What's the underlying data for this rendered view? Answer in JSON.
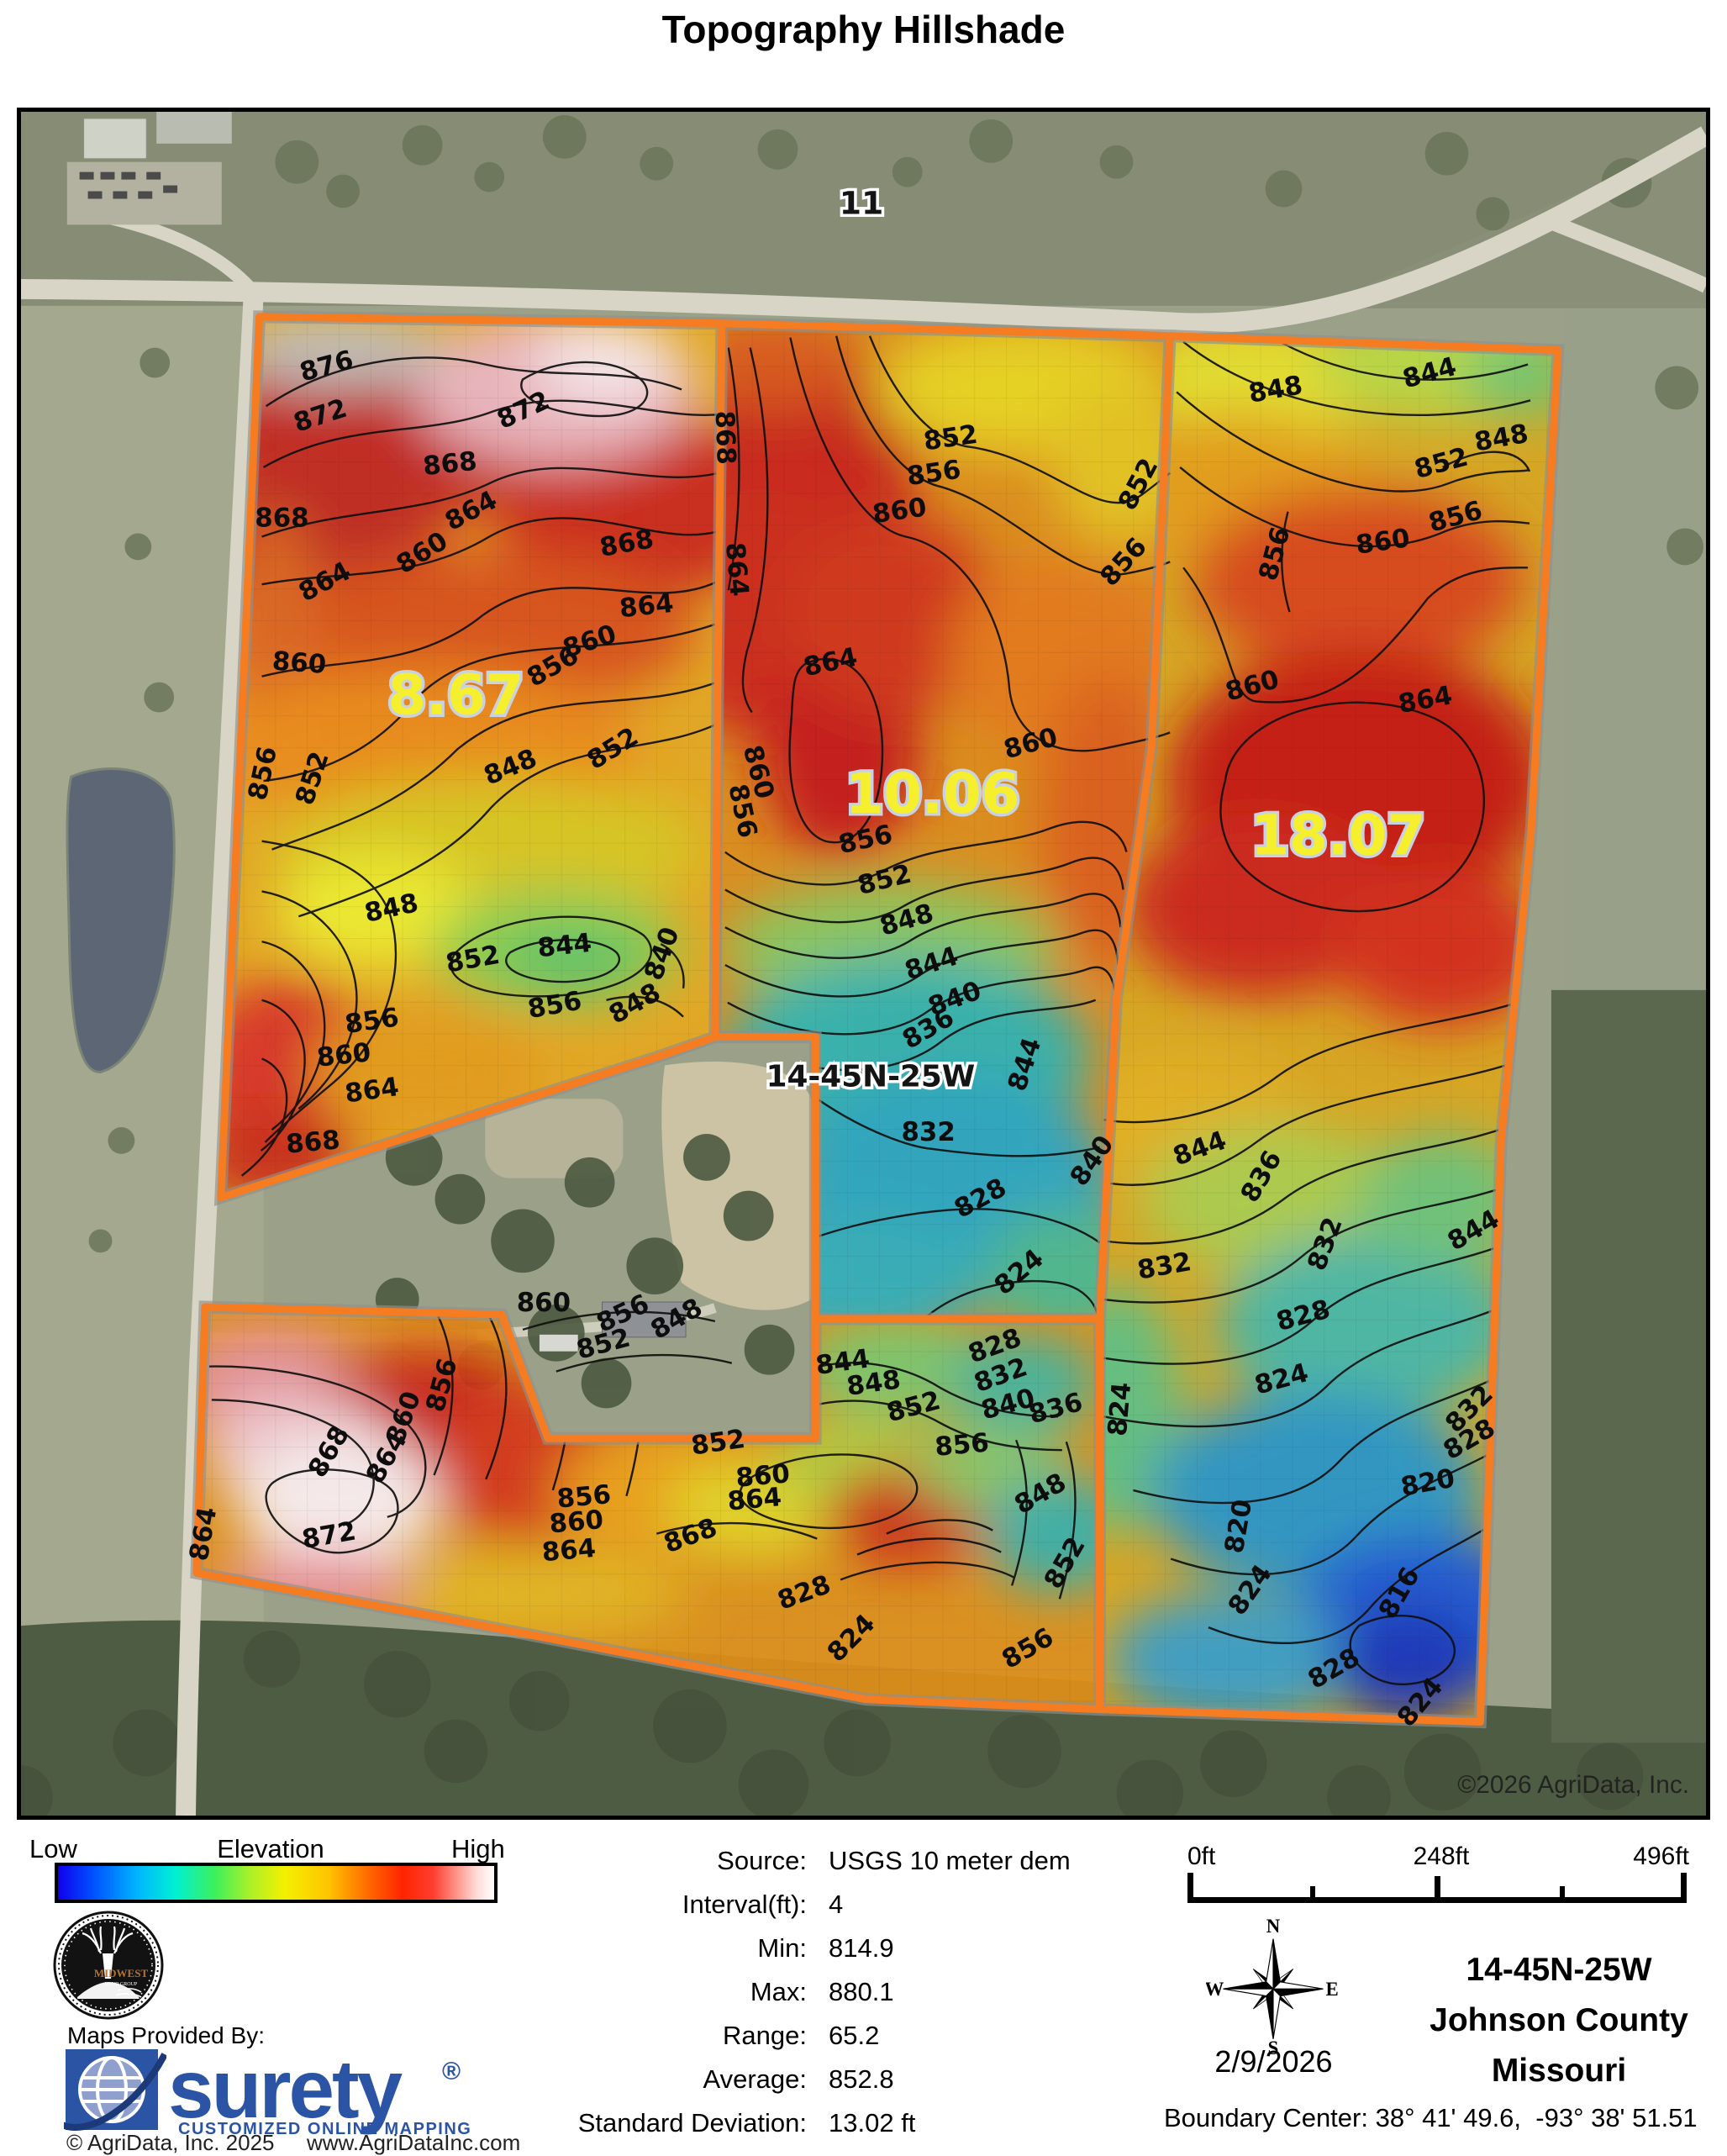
{
  "title": "Topography Hillshade",
  "map": {
    "section_label_top": "11",
    "section_label_center": "14-45N-25W",
    "copyright": "©2026 AgriData, Inc.",
    "parcel_labels": [
      [
        "8.67",
        520,
        720
      ],
      [
        "10.06",
        1090,
        838
      ],
      [
        "18.07",
        1575,
        888
      ]
    ],
    "contour_labels": [
      [
        "876",
        368,
        314,
        -15
      ],
      [
        "872",
        361,
        373,
        -18
      ],
      [
        "872",
        605,
        366,
        -25
      ],
      [
        "868",
        514,
        431,
        -6
      ],
      [
        "868",
        312,
        496,
        0
      ],
      [
        "864",
        543,
        486,
        -28
      ],
      [
        "868",
        726,
        526,
        -10
      ],
      [
        "860",
        485,
        536,
        -32
      ],
      [
        "864",
        368,
        571,
        -28
      ],
      [
        "864",
        749,
        601,
        -6
      ],
      [
        "860",
        332,
        669,
        4
      ],
      [
        "860",
        683,
        643,
        -18
      ],
      [
        "856",
        641,
        672,
        -30
      ],
      [
        "852",
        713,
        770,
        -32
      ],
      [
        "848",
        589,
        793,
        -22
      ],
      [
        "856",
        299,
        793,
        -78
      ],
      [
        "852",
        358,
        800,
        -72
      ],
      [
        "848",
        445,
        962,
        -12
      ],
      [
        "844",
        651,
        1007,
        -6
      ],
      [
        "840",
        776,
        1010,
        -70
      ],
      [
        "848",
        739,
        1075,
        -30
      ],
      [
        "852",
        542,
        1023,
        -10
      ],
      [
        "856",
        421,
        1097,
        -8
      ],
      [
        "860",
        387,
        1138,
        -6
      ],
      [
        "864",
        421,
        1180,
        -8
      ],
      [
        "868",
        350,
        1242,
        -5
      ],
      [
        "856",
        640,
        1078,
        -10
      ],
      [
        "868",
        832,
        390,
        88
      ],
      [
        "864",
        846,
        548,
        85
      ],
      [
        "852",
        1113,
        400,
        -8
      ],
      [
        "856",
        1093,
        442,
        -8
      ],
      [
        "860",
        1052,
        487,
        -8
      ],
      [
        "852",
        1345,
        450,
        -62
      ],
      [
        "856",
        1326,
        545,
        -48
      ],
      [
        "864",
        970,
        668,
        -12
      ],
      [
        "860",
        1210,
        765,
        -15
      ],
      [
        "860",
        872,
        792,
        75
      ],
      [
        "856",
        853,
        838,
        78
      ],
      [
        "856",
        1012,
        880,
        -12
      ],
      [
        "852",
        1035,
        928,
        -14
      ],
      [
        "848",
        1062,
        976,
        -16
      ],
      [
        "844",
        1092,
        1028,
        -18
      ],
      [
        "840",
        1120,
        1070,
        -20
      ],
      [
        "836",
        1090,
        1105,
        -30
      ],
      [
        "832",
        1085,
        1230,
        0
      ],
      [
        "844",
        1210,
        1142,
        -72
      ],
      [
        "828",
        1152,
        1308,
        -28
      ],
      [
        "824",
        1200,
        1395,
        -40
      ],
      [
        "860",
        625,
        1434,
        0
      ],
      [
        "856",
        724,
        1446,
        -25
      ],
      [
        "852",
        699,
        1483,
        -15
      ],
      [
        "848",
        789,
        1452,
        -30
      ],
      [
        "848",
        1502,
        342,
        -10
      ],
      [
        "844",
        1687,
        322,
        -15
      ],
      [
        "848",
        1772,
        400,
        -10
      ],
      [
        "852",
        1701,
        430,
        -15
      ],
      [
        "856",
        1718,
        494,
        -15
      ],
      [
        "860",
        1630,
        524,
        -8
      ],
      [
        "856",
        1509,
        531,
        -75
      ],
      [
        "860",
        1475,
        696,
        -15
      ],
      [
        "864",
        1681,
        713,
        -10
      ],
      [
        "840",
        1289,
        1260,
        -55
      ],
      [
        "844",
        1413,
        1249,
        -20
      ],
      [
        "836",
        1492,
        1278,
        -60
      ],
      [
        "832",
        1369,
        1390,
        -10
      ],
      [
        "832",
        1569,
        1357,
        -70
      ],
      [
        "844",
        1742,
        1346,
        -30
      ],
      [
        "828",
        1536,
        1449,
        -15
      ],
      [
        "824",
        1510,
        1525,
        -15
      ],
      [
        "824",
        1324,
        1552,
        -85
      ],
      [
        "832",
        1739,
        1558,
        -45
      ],
      [
        "828",
        1737,
        1596,
        -30
      ],
      [
        "820",
        1684,
        1649,
        -10
      ],
      [
        "820",
        1466,
        1693,
        -80
      ],
      [
        "824",
        1478,
        1773,
        -55
      ],
      [
        "816",
        1657,
        1776,
        -60
      ],
      [
        "828",
        1575,
        1870,
        -30
      ],
      [
        "824",
        1681,
        1908,
        -50
      ],
      [
        "828",
        1168,
        1485,
        -20
      ],
      [
        "832",
        1175,
        1520,
        -20
      ],
      [
        "840",
        1183,
        1555,
        -15
      ],
      [
        "836",
        1240,
        1560,
        -15
      ],
      [
        "868",
        377,
        1607,
        -60
      ],
      [
        "864",
        228,
        1702,
        -80
      ],
      [
        "872",
        370,
        1712,
        -10
      ],
      [
        "860",
        467,
        1565,
        -70
      ],
      [
        "856",
        513,
        1525,
        -75
      ],
      [
        "864",
        446,
        1614,
        -60
      ],
      [
        "856",
        674,
        1666,
        -5
      ],
      [
        "860",
        665,
        1696,
        -5
      ],
      [
        "864",
        656,
        1730,
        -5
      ],
      [
        "868",
        804,
        1712,
        -20
      ],
      [
        "852",
        835,
        1601,
        -8
      ],
      [
        "844",
        984,
        1505,
        -8
      ],
      [
        "848",
        1021,
        1530,
        -8
      ],
      [
        "852",
        1070,
        1558,
        -15
      ],
      [
        "856",
        1126,
        1604,
        -5
      ],
      [
        "860",
        888,
        1641,
        -5
      ],
      [
        "864",
        878,
        1669,
        -5
      ],
      [
        "848",
        1224,
        1661,
        -30
      ],
      [
        "852",
        1257,
        1740,
        -60
      ],
      [
        "856",
        1209,
        1846,
        -30
      ],
      [
        "828",
        940,
        1780,
        -20
      ],
      [
        "824",
        1000,
        1832,
        -45
      ]
    ]
  },
  "legend": {
    "low": "Low",
    "title": "Elevation",
    "high": "High",
    "gradient": [
      "#1000ee 0%",
      "#0050ff 8%",
      "#00b4ff 18%",
      "#00f0d2 27%",
      "#3df05c 36%",
      "#aaf028 44%",
      "#f4f000 52%",
      "#ffc400 62%",
      "#ff7400 70%",
      "#ff2400 79%",
      "#ff3d30 86%",
      "#ff9e94 92%",
      "#ffdcd8 96%",
      "#ffffff 100%"
    ]
  },
  "stats": {
    "rows": [
      {
        "label": "Source:",
        "value": "USGS 10 meter dem"
      },
      {
        "label": "Interval(ft):",
        "value": "4"
      },
      {
        "label": "Min:",
        "value": "814.9"
      },
      {
        "label": "Max:",
        "value": "880.1"
      },
      {
        "label": "Range:",
        "value": "65.2"
      },
      {
        "label": "Average:",
        "value": "852.8"
      },
      {
        "label": "Standard Deviation:",
        "value": "13.02 ft"
      }
    ]
  },
  "scalebar": {
    "start": "0ft",
    "middle": "248ft",
    "end": "496ft"
  },
  "compass": {
    "n": "N",
    "e": "E",
    "s": "S",
    "w": "W"
  },
  "info": {
    "date": "2/9/2026",
    "section": "14-45N-25W",
    "county": "Johnson County",
    "state": "Missouri",
    "boundary_center": "Boundary Center: 38° 41' 49.6,  -93° 38' 51.51"
  },
  "provider": {
    "maps_provided_by": "Maps Provided By:",
    "brand": "surety",
    "registered": "®",
    "tagline": "CUSTOMIZED ONLINE MAPPING",
    "copyright": "© AgriData, Inc. 2025",
    "website": "www.AgriDataInc.com",
    "midwest_line1": "MIDWEST",
    "midwest_line2": "LAND GROUP"
  },
  "colors": {
    "boundary": "#F57C20",
    "surety_blue": "#2B55A4",
    "label_yellow": "#F6EF2D",
    "contour": "#101010"
  }
}
